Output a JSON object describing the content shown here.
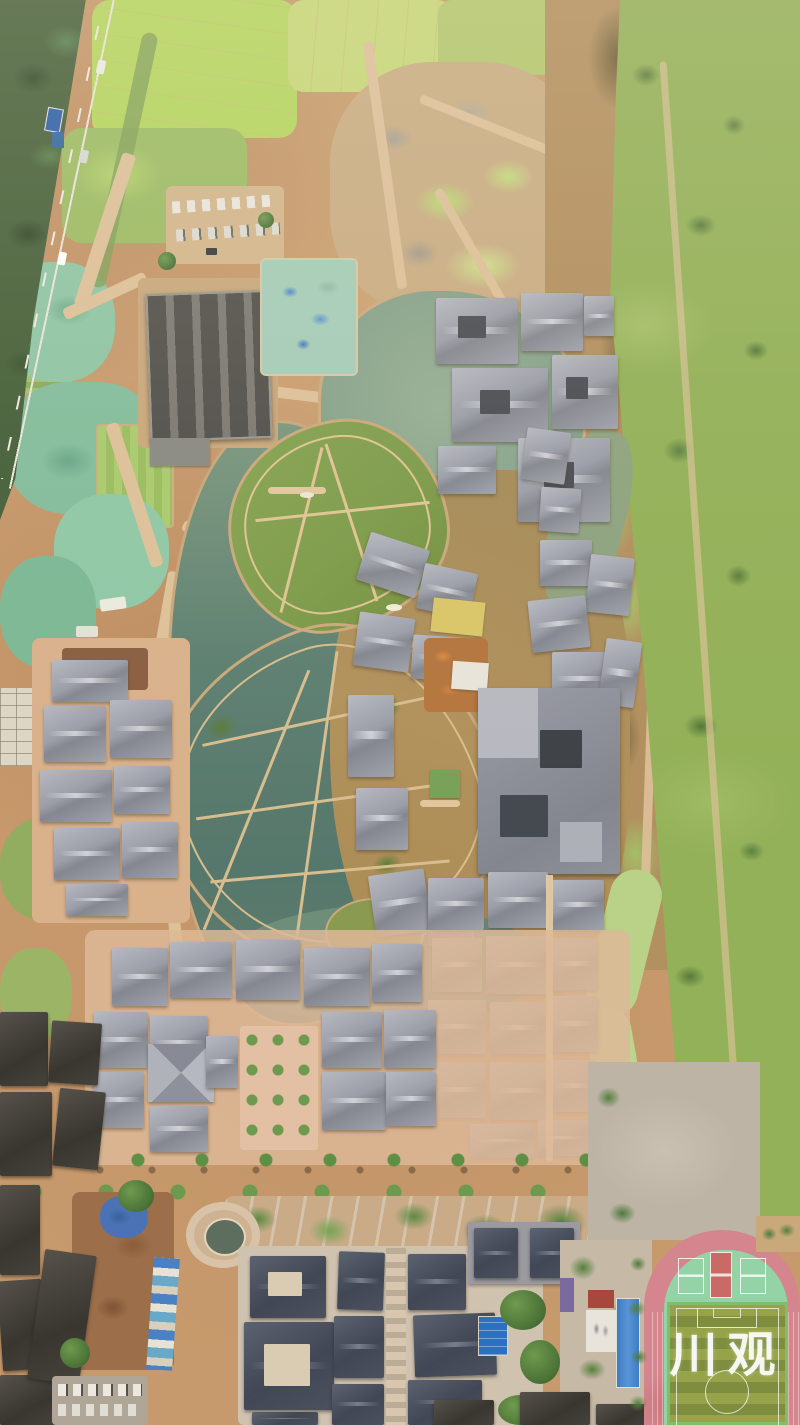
{
  "scene": {
    "type": "aerial-photograph",
    "description": "Top-down drone photo of an ancient-style riverside town under construction: lake with landscaped islands, gray-tile roof complexes, construction dirt, highway with forest at top-left, wide green meadow along the right, old town and temple courtyards at the bottom, and a school running track with striped football pitch at bottom-right.",
    "watermark": {
      "text": "川观",
      "color": "#ffffff"
    }
  },
  "palette": {
    "dirt": "#c79a6d",
    "construction_dirt": "#b17c50",
    "field_green": "#b5d75f",
    "meadow_green": "#93b158",
    "forest_green": "#46603a",
    "lake_teal": "#5e8071",
    "lake_brown": "#ab8f5c",
    "island_olive": "#8e9449",
    "roof_gray": "#9b9ea8",
    "roof_slate": "#414754",
    "roof_old_dark": "#39362f",
    "track_red": "#d5858d",
    "court_green": "#94d3a6",
    "pitch_stripe_light": "#97a349",
    "pitch_stripe_dark": "#7e8d3e",
    "tarp_teal": "#8fc6a4",
    "tarp_blue": "#4a72b4",
    "paving_pink": "#e0bfa4"
  }
}
